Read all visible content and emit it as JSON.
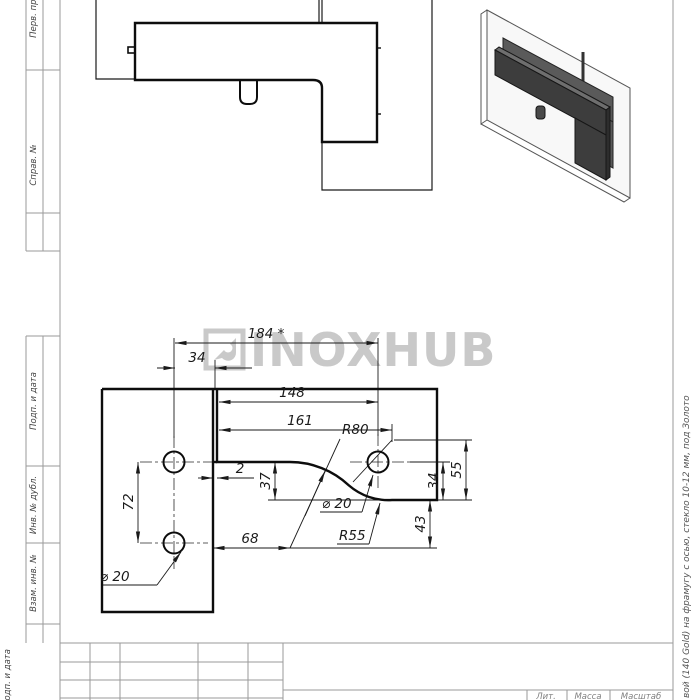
{
  "watermark": {
    "text": "INOXHUB",
    "color": "#c9c9c9"
  },
  "margin_left": {
    "labels": [
      {
        "text": "Перв. примен."
      },
      {
        "text": "Справ. №"
      },
      {
        "text": "Подп. и дата"
      },
      {
        "text": "Инв. № дубл."
      },
      {
        "text": "Взам. инв. №"
      },
      {
        "text": "Подп. и дата"
      }
    ]
  },
  "margin_right": {
    "description": "вой (140 Gold)  на фрамугу с осью, стекло 10-12 мм, под Золото"
  },
  "main_view": {
    "dims": {
      "d184": "184 *",
      "d34_top": "34",
      "d148": "148",
      "d161": "161",
      "r80": "R80",
      "d2": "2",
      "d37": "37",
      "dia20_right": "⌀ 20",
      "r55": "R55",
      "d68": "68",
      "d72": "72",
      "dia20_left": "⌀ 20",
      "d34_right": "34",
      "d55": "55",
      "d43": "43"
    }
  },
  "title_block": {
    "lit": "Лит.",
    "massa": "Масса",
    "masshtab": "Масштаб"
  },
  "colors": {
    "part_line": "#0d0d0d",
    "dim_line": "#1a1a1a",
    "frame_line": "#9a9a9a",
    "fitting_dark": "#3d3d3d",
    "fitting_mid": "#5a5a5a",
    "glass_fill": "#f4f4f4"
  }
}
